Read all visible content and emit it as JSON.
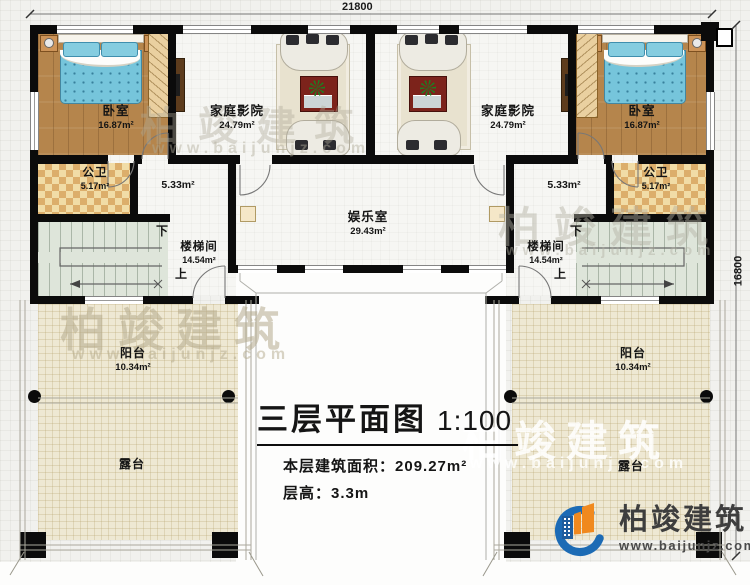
{
  "dimensions": {
    "width": "21800",
    "height": "16800"
  },
  "title": {
    "main": "三层平面图",
    "scale": "1:100",
    "area_label": "本层建筑面积：",
    "area_value": "209.27m²",
    "floor_height_label": "层高：",
    "floor_height_value": "3.3m"
  },
  "rooms": {
    "bedroom_left": {
      "name": "卧室",
      "area": "16.87m²"
    },
    "bedroom_right": {
      "name": "卧室",
      "area": "16.87m²"
    },
    "theater_left": {
      "name": "家庭影院",
      "area": "24.79m²"
    },
    "theater_right": {
      "name": "家庭影院",
      "area": "24.79m²"
    },
    "bath_left": {
      "name": "公卫",
      "area": "5.17m²"
    },
    "bath_right": {
      "name": "公卫",
      "area": "5.17m²"
    },
    "hall_left": {
      "area": "5.33m²"
    },
    "hall_right": {
      "area": "5.33m²"
    },
    "game_room": {
      "name": "娱乐室",
      "area": "29.43m²"
    },
    "stair_left": {
      "name": "楼梯间",
      "area": "14.54m²",
      "up": "上",
      "down": "下"
    },
    "stair_right": {
      "name": "楼梯间",
      "area": "14.54m²",
      "up": "上",
      "down": "下"
    },
    "balcony_left": {
      "name": "阳台",
      "area": "10.34m²"
    },
    "balcony_right": {
      "name": "阳台",
      "area": "10.34m²"
    },
    "terrace_left": {
      "name": "露台"
    },
    "terrace_right": {
      "name": "露台"
    }
  },
  "branding": {
    "company": "柏竣建筑",
    "website": "www.baijunjz.com",
    "accent_blue": "#1c6bb5",
    "accent_orange": "#f0891e"
  },
  "watermark": {
    "text": "柏竣建筑",
    "url": "www.baijunjz.com"
  }
}
